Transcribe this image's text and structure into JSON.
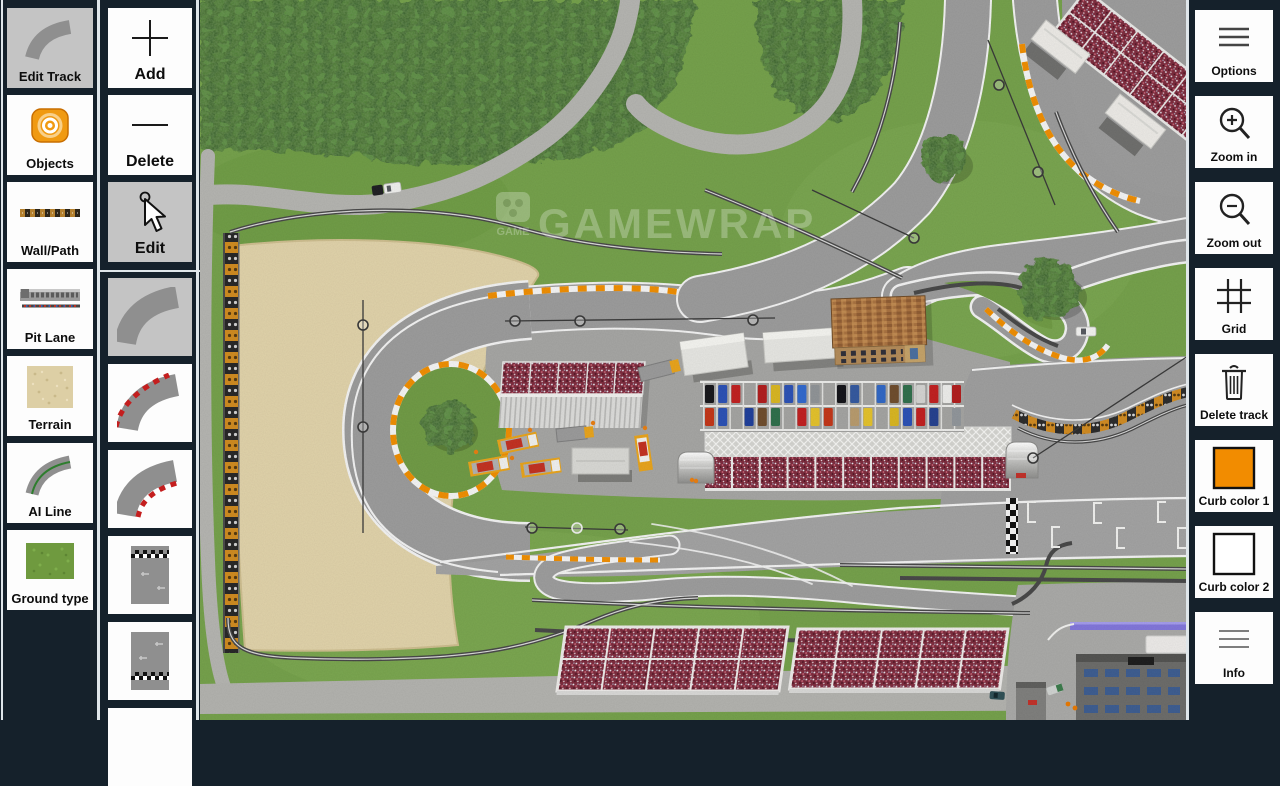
{
  "app": {
    "name": "race-track-editor"
  },
  "left_toolbar": {
    "items": [
      {
        "label": "Edit Track",
        "icon": "curved-road",
        "selected": true
      },
      {
        "label": "Objects",
        "icon": "orange-target",
        "selected": false
      },
      {
        "label": "Wall/Path",
        "icon": "tire-wall-strip",
        "selected": false
      },
      {
        "label": "Pit Lane",
        "icon": "pit-building",
        "selected": false
      },
      {
        "label": "Terrain",
        "icon": "sand-swatch",
        "selected": false
      },
      {
        "label": "AI Line",
        "icon": "curve-green-line",
        "selected": false
      },
      {
        "label": "Ground type",
        "icon": "grass-swatch",
        "selected": false
      }
    ]
  },
  "edit_toolbar": {
    "items": [
      {
        "label": "Add",
        "icon": "plus",
        "selected": false
      },
      {
        "label": "Delete",
        "icon": "minus",
        "selected": false
      },
      {
        "label": "Edit",
        "icon": "cursor-arrow",
        "selected": true
      }
    ]
  },
  "piece_palette": {
    "items": [
      {
        "name": "curve-plain",
        "selected": true
      },
      {
        "name": "curve-curb-outer",
        "selected": false
      },
      {
        "name": "curve-curb-inner",
        "selected": false
      },
      {
        "name": "straight-finish-top",
        "selected": false
      },
      {
        "name": "straight-finish-bottom",
        "selected": false
      },
      {
        "name": "blank-piece",
        "selected": false
      }
    ]
  },
  "right_toolbar": {
    "items": [
      {
        "label": "Options",
        "icon": "menu-lines"
      },
      {
        "label": "Zoom in",
        "icon": "magnifier-plus"
      },
      {
        "label": "Zoom out",
        "icon": "magnifier-minus"
      },
      {
        "label": "Grid",
        "icon": "grid-hash"
      },
      {
        "label": "Delete track",
        "icon": "trash-can"
      },
      {
        "label": "Curb color 1",
        "icon": "color-swatch"
      },
      {
        "label": "Curb color 2",
        "icon": "color-swatch"
      },
      {
        "label": "Info",
        "icon": "thin-lines"
      }
    ]
  },
  "colors": {
    "curb_color_1": "#F28C00",
    "curb_color_2": "#FFFFFF",
    "sidebar_bg": "#15212B",
    "selected_button": "#C4C4C4",
    "grass": "#74A04A",
    "sand": "#E0D2A9",
    "asphalt": "#9B9B9B",
    "crowd": "#7C2A3C",
    "pit_line_purple": "#8175DA"
  },
  "map": {
    "watermark": "GAMEWRAP",
    "watermark_logo": "GAME"
  }
}
